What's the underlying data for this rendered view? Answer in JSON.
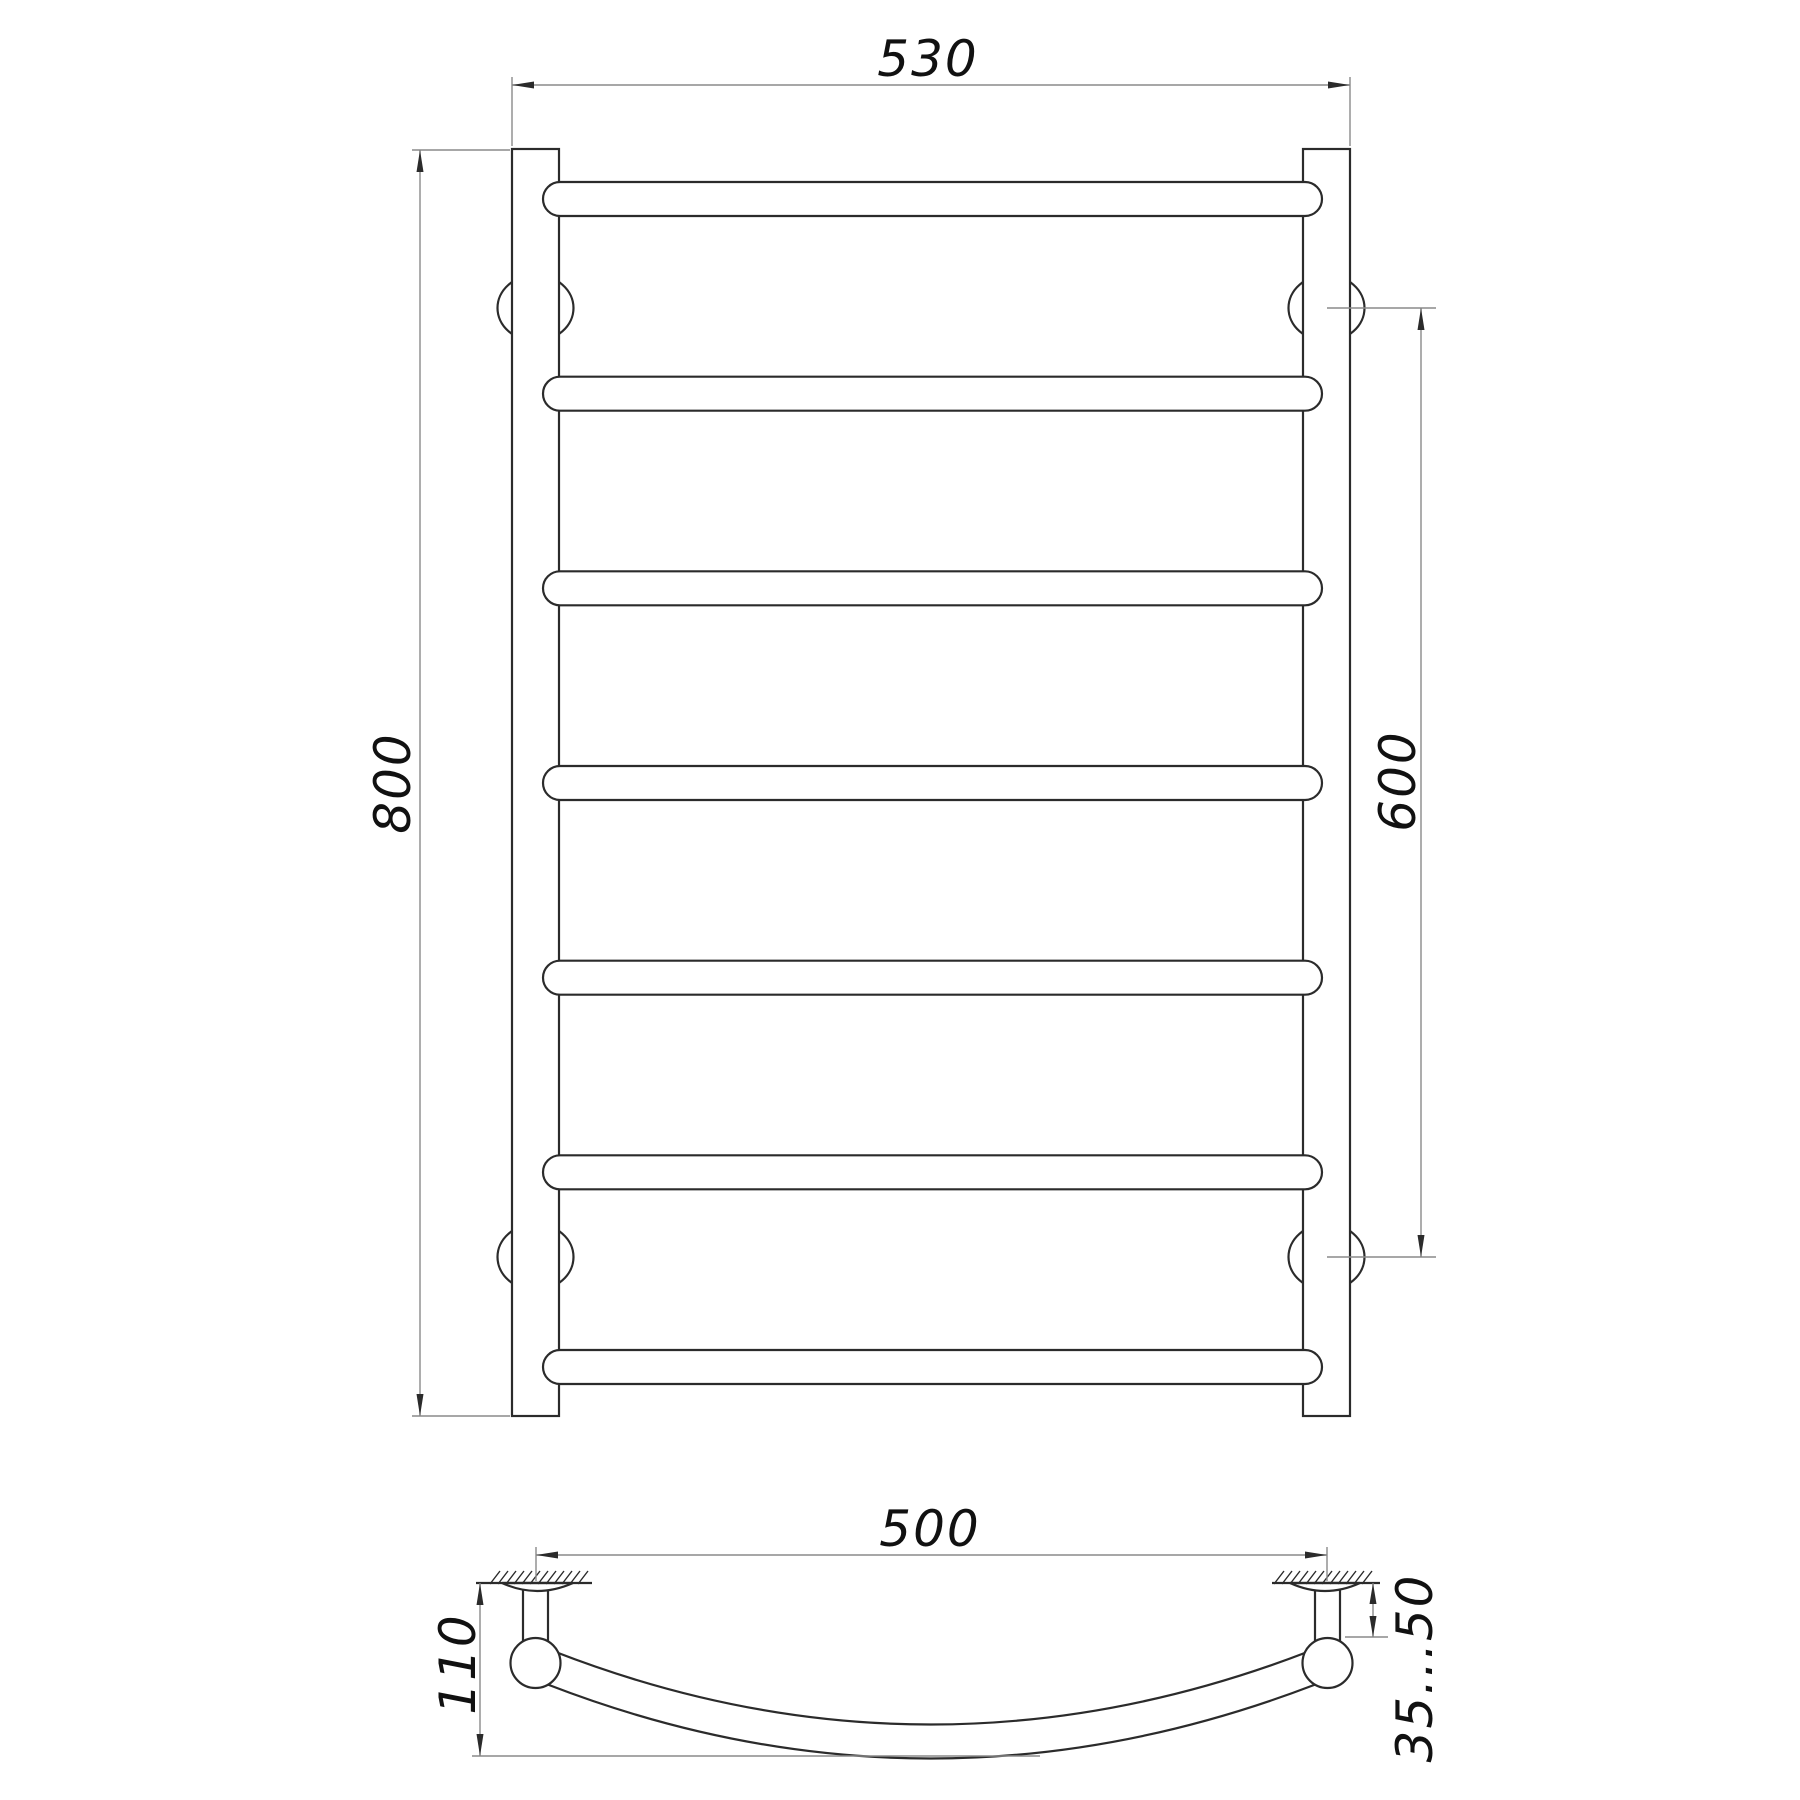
{
  "front_view": {
    "overall_width": "530",
    "overall_height": "800",
    "mounting_distance": "600"
  },
  "profile_view": {
    "bar_width": "500",
    "depth": "110",
    "wall_clearance": "35...50"
  }
}
